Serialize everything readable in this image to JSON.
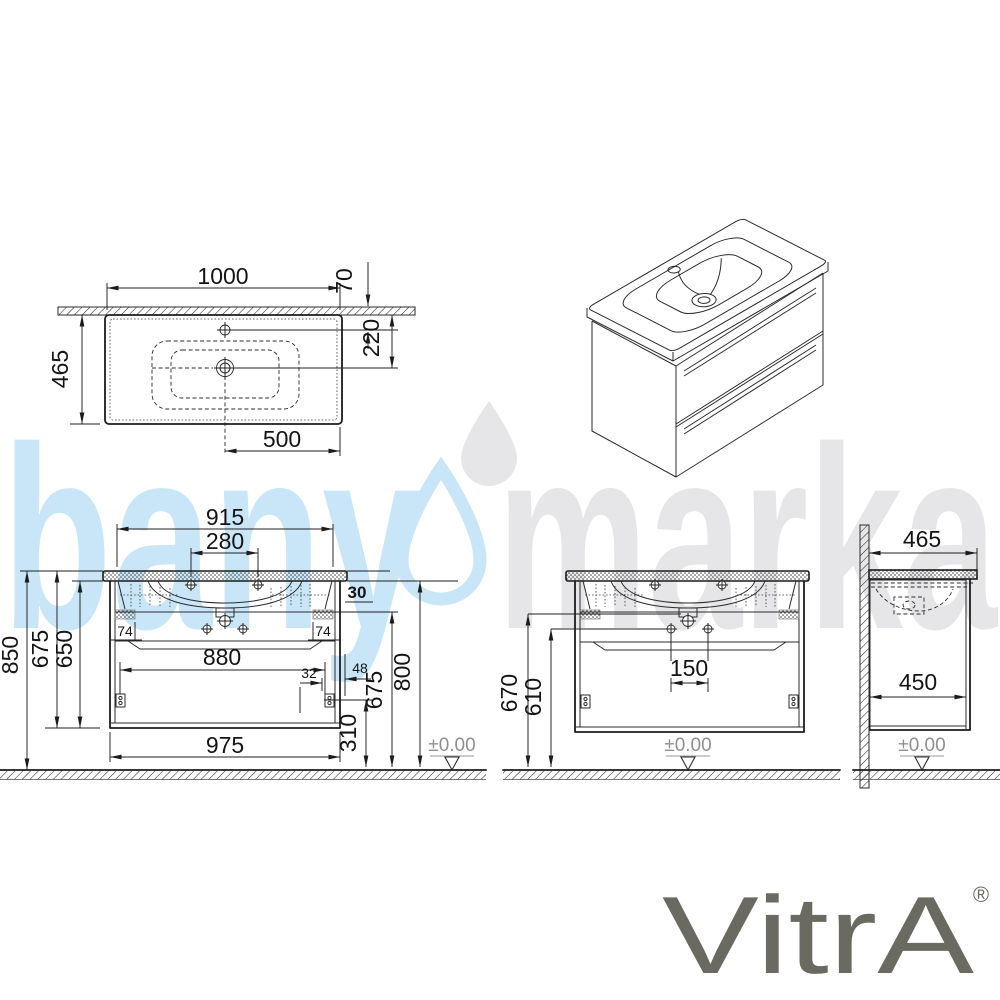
{
  "watermark": {
    "text_left": "bany",
    "text_right": "marka",
    "blue": "#c8e6f7",
    "gray": "#e6e6e9"
  },
  "brand": {
    "name": "VitrA",
    "registered": "®",
    "color": "#6b6a60"
  },
  "plan_view": {
    "width": "1000",
    "back_offset": "70",
    "depth": "465",
    "drain_from_wall": "220",
    "drain_to_edge": "500"
  },
  "front_view": {
    "top_width": "915",
    "tap_holes": "280",
    "total_height": "850",
    "body_height": "675",
    "inner_height": "650",
    "top_thickness": "30",
    "bracket_left": "74",
    "bracket_right": "74",
    "drawer_width": "880",
    "dim_32": "32",
    "dim_48": "48",
    "right_height": "675",
    "rim_height": "800",
    "bottom_height": "310",
    "body_width": "975",
    "floor_level": "±0.00"
  },
  "detail_view": {
    "drain_height": "670",
    "holes_height": "610",
    "holes_spacing": "150",
    "floor_level": "±0.00"
  },
  "side_view": {
    "top_depth": "465",
    "body_depth": "450",
    "floor_level": "±0.00"
  }
}
